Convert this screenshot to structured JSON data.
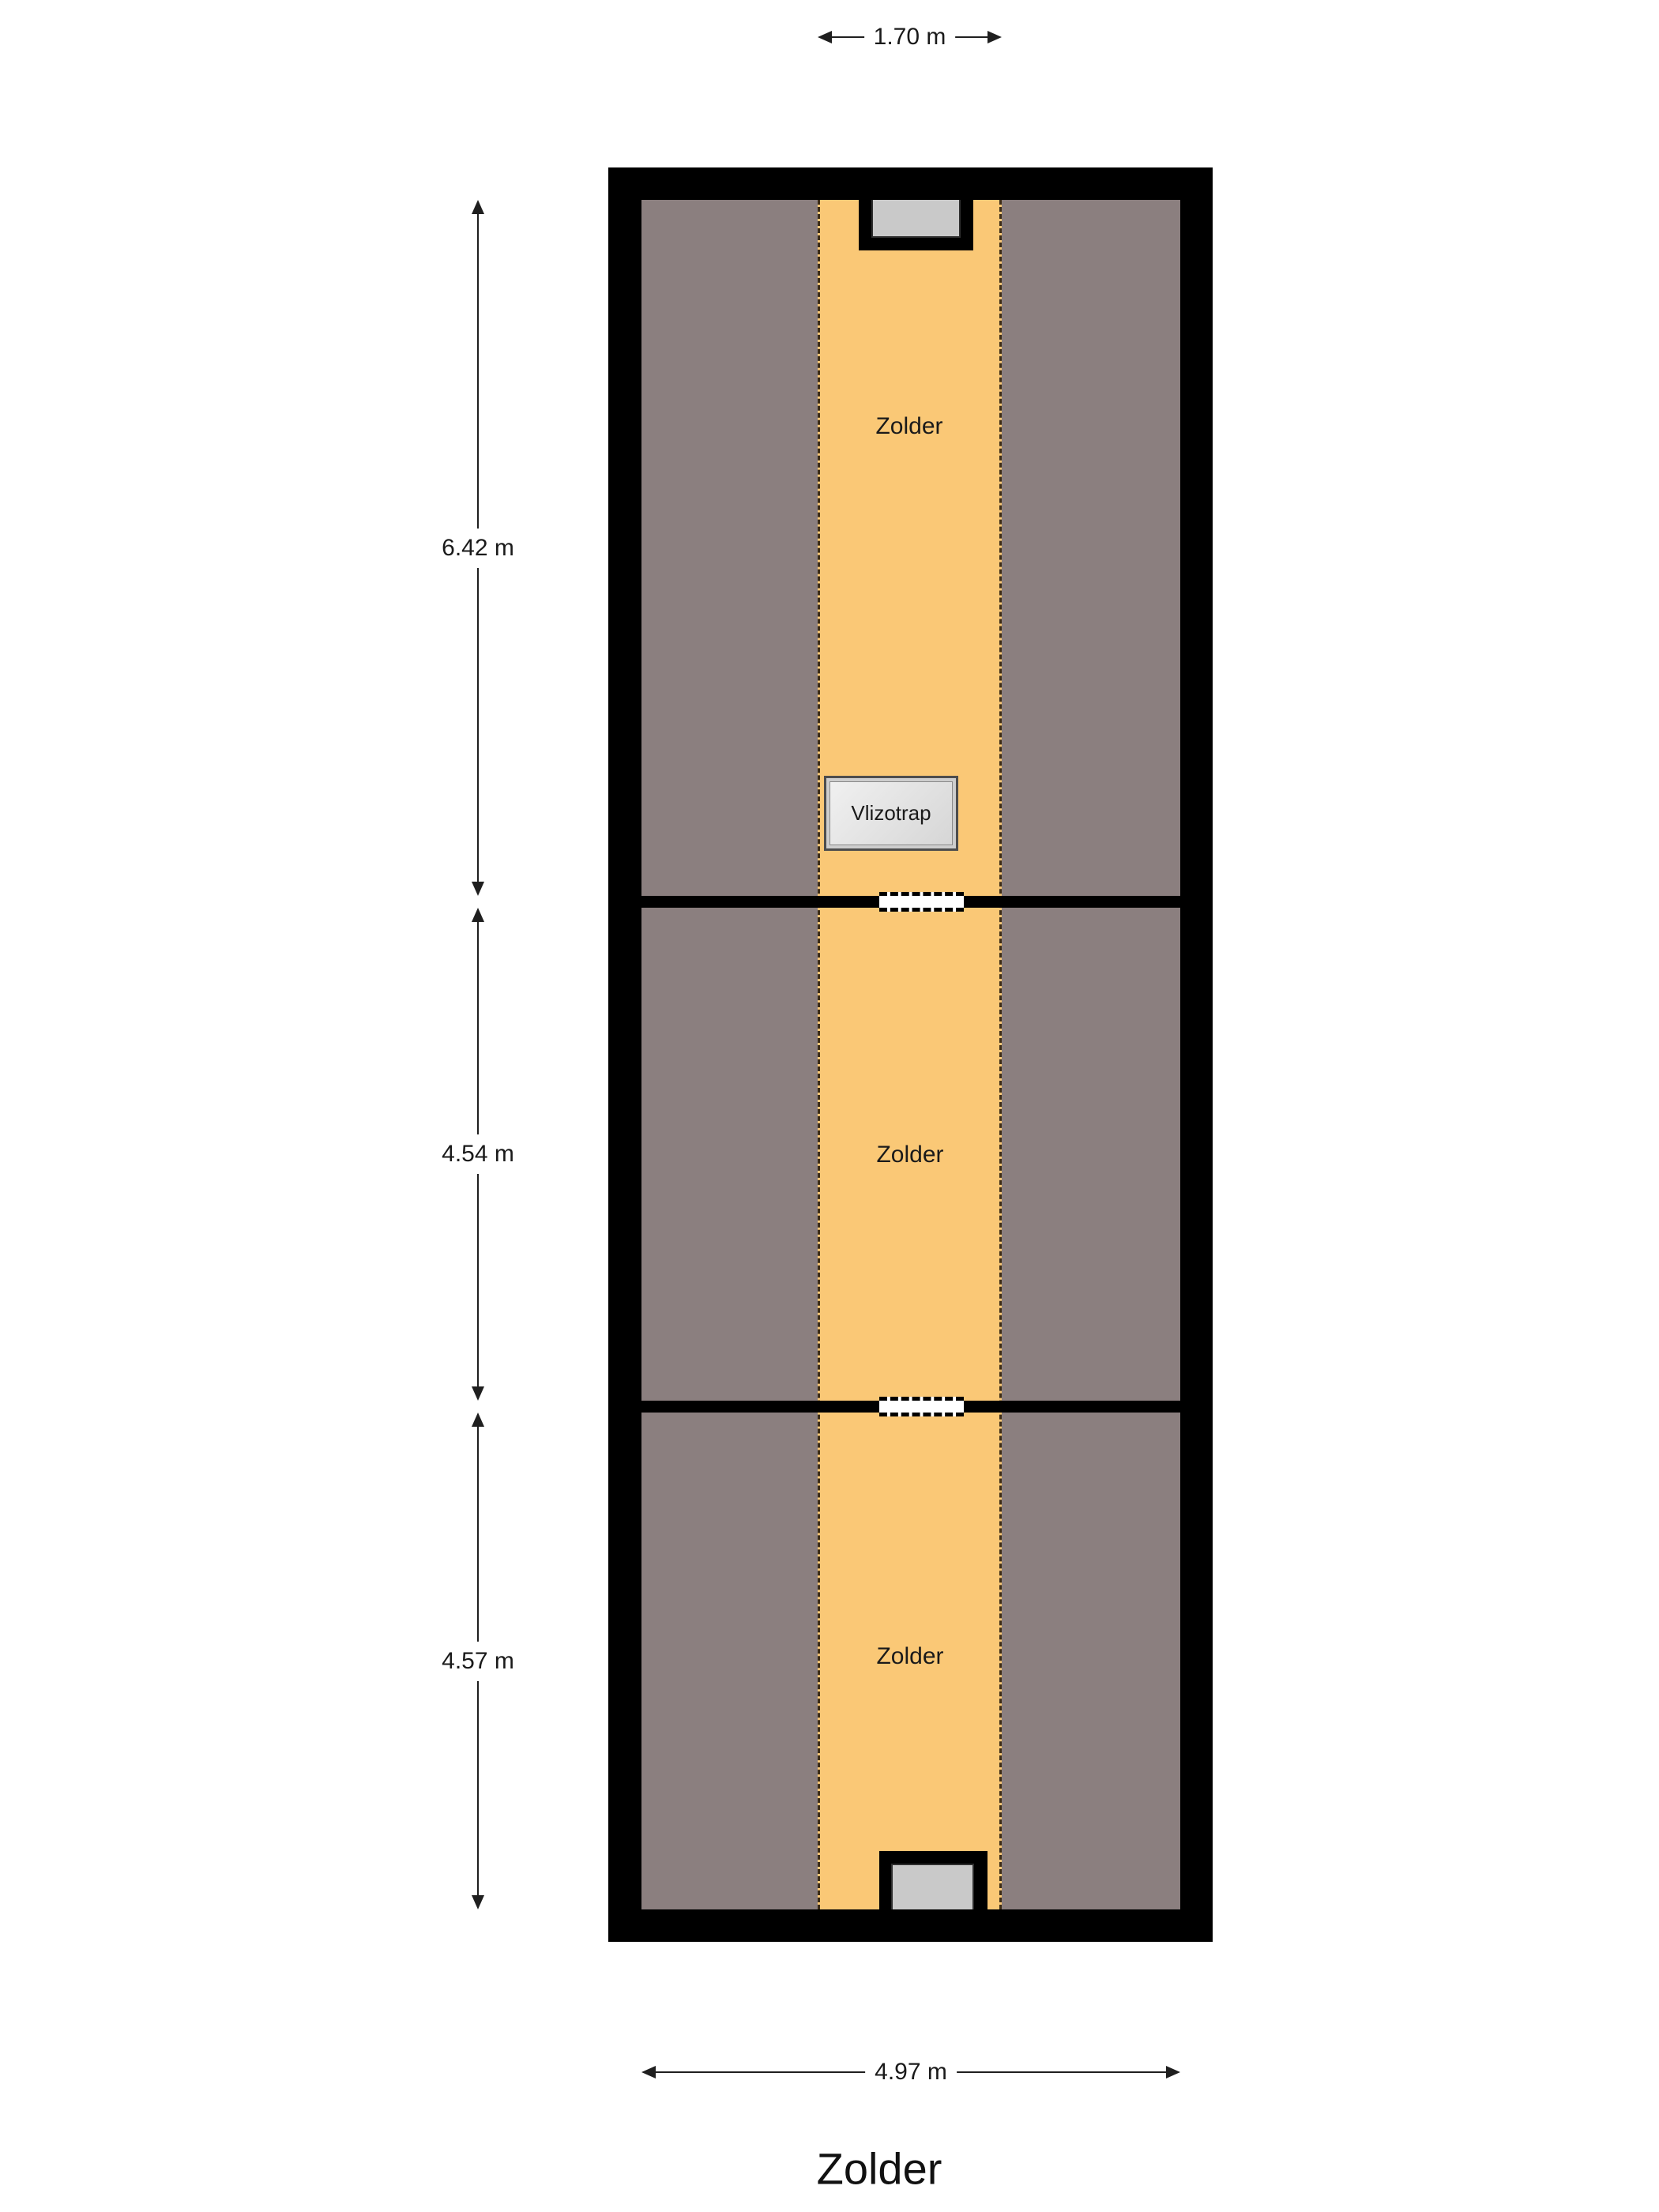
{
  "title": "Zolder",
  "dimensions": {
    "top_width": "1.70 m",
    "bottom_width": "4.97 m"
  },
  "sections": [
    {
      "label": "Zolder",
      "height_label": "6.42 m"
    },
    {
      "label": "Zolder",
      "height_label": "4.54 m"
    },
    {
      "label": "Zolder",
      "height_label": "4.57 m"
    }
  ],
  "loft_ladder": {
    "label": "Vlizotrap"
  },
  "colors": {
    "wall": "#000000",
    "low_headroom_area": "#8b7f7f",
    "floor_area": "#fac876",
    "window_fill": "#c9c9c9",
    "dimension_line": "#1f1f1f"
  }
}
